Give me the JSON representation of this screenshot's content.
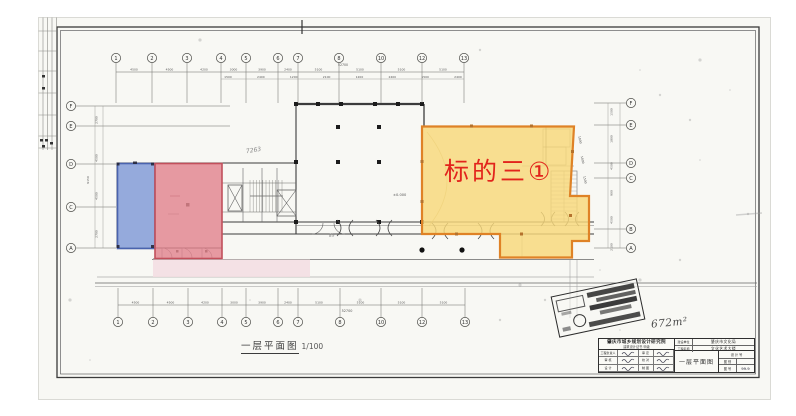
{
  "highlight": {
    "label": "标的三①",
    "label_color": "#e2241c",
    "regions": {
      "blue": {
        "fill": "#7c96d6",
        "stroke": "#4a63ae"
      },
      "red": {
        "fill": "#e2848f",
        "stroke": "#c2505c"
      },
      "pink": {
        "fill": "#f3dde2"
      },
      "yellow": {
        "fill": "#f8d87a",
        "stroke": "#df8226"
      }
    }
  },
  "plan": {
    "scale_name": "一层平面图",
    "scale_ratio": "1/100",
    "notes": {
      "area": "672m²",
      "level": "±0.000",
      "sketch": "7263",
      "pencil": "89"
    },
    "grid": {
      "top": [
        {
          "n": "1",
          "x": 116
        },
        {
          "n": "2",
          "x": 152
        },
        {
          "n": "3",
          "x": 187
        },
        {
          "n": "4",
          "x": 221
        },
        {
          "n": "5",
          "x": 246
        },
        {
          "n": "6",
          "x": 278
        },
        {
          "n": "7",
          "x": 298
        },
        {
          "n": "8",
          "x": 339
        },
        {
          "n": "10",
          "x": 381
        },
        {
          "n": "12",
          "x": 422
        },
        {
          "n": "13",
          "x": 464
        }
      ],
      "bottom": [
        {
          "n": "1",
          "x": 118
        },
        {
          "n": "2",
          "x": 153
        },
        {
          "n": "3",
          "x": 188
        },
        {
          "n": "4",
          "x": 222
        },
        {
          "n": "5",
          "x": 246
        },
        {
          "n": "6",
          "x": 278
        },
        {
          "n": "7",
          "x": 298
        },
        {
          "n": "8",
          "x": 340
        },
        {
          "n": "10",
          "x": 381
        },
        {
          "n": "12",
          "x": 422
        },
        {
          "n": "13",
          "x": 465
        }
      ],
      "left": [
        {
          "n": "F",
          "y": 106
        },
        {
          "n": "E",
          "y": 126
        },
        {
          "n": "D",
          "y": 164
        },
        {
          "n": "C",
          "y": 207
        },
        {
          "n": "A",
          "y": 248
        }
      ],
      "right": [
        {
          "n": "F",
          "y": 103
        },
        {
          "n": "E",
          "y": 125
        },
        {
          "n": "D",
          "y": 163
        },
        {
          "n": "C",
          "y": 178
        },
        {
          "n": "B",
          "y": 229
        },
        {
          "n": "A",
          "y": 248
        }
      ]
    },
    "dims": {
      "top": [
        "4500",
        "4500",
        "4200",
        "3000",
        "3900",
        "2400",
        "5100",
        "5100",
        "5100",
        "5100"
      ],
      "top_sub": [
        "1500",
        "2400",
        "1200",
        "2100",
        "1200",
        "2400",
        "1500",
        "2400"
      ],
      "bottom": [
        "4500",
        "4500",
        "4200",
        "3000",
        "3900",
        "2400",
        "5100",
        "5100",
        "5100",
        "5100"
      ],
      "total": "52700",
      "left": [
        "2700",
        "4500",
        "4500",
        "2700"
      ],
      "left_total": "9150",
      "right": [
        "1500",
        "1800",
        "4500",
        "900",
        "4500",
        "2100"
      ],
      "slant": [
        "1800",
        "1800",
        "1500"
      ]
    }
  },
  "titleblock": {
    "institute": "肇庆市城乡规划设计研究院",
    "institute_sub": "建筑设计证书 甲级",
    "client_label": "建设单位",
    "client_value": "肇庆市文化局",
    "project_label": "工程名称",
    "project_value": "文化艺术大楼",
    "drawing_title": "一层平面图",
    "sig_labels": [
      "工程负责人",
      "审 定",
      "审 核",
      "校 对",
      "设 计",
      "制 图"
    ],
    "no_header": "设 计 号",
    "no_row1": "图 别",
    "no_row2": "图 号",
    "date": "99.9"
  }
}
